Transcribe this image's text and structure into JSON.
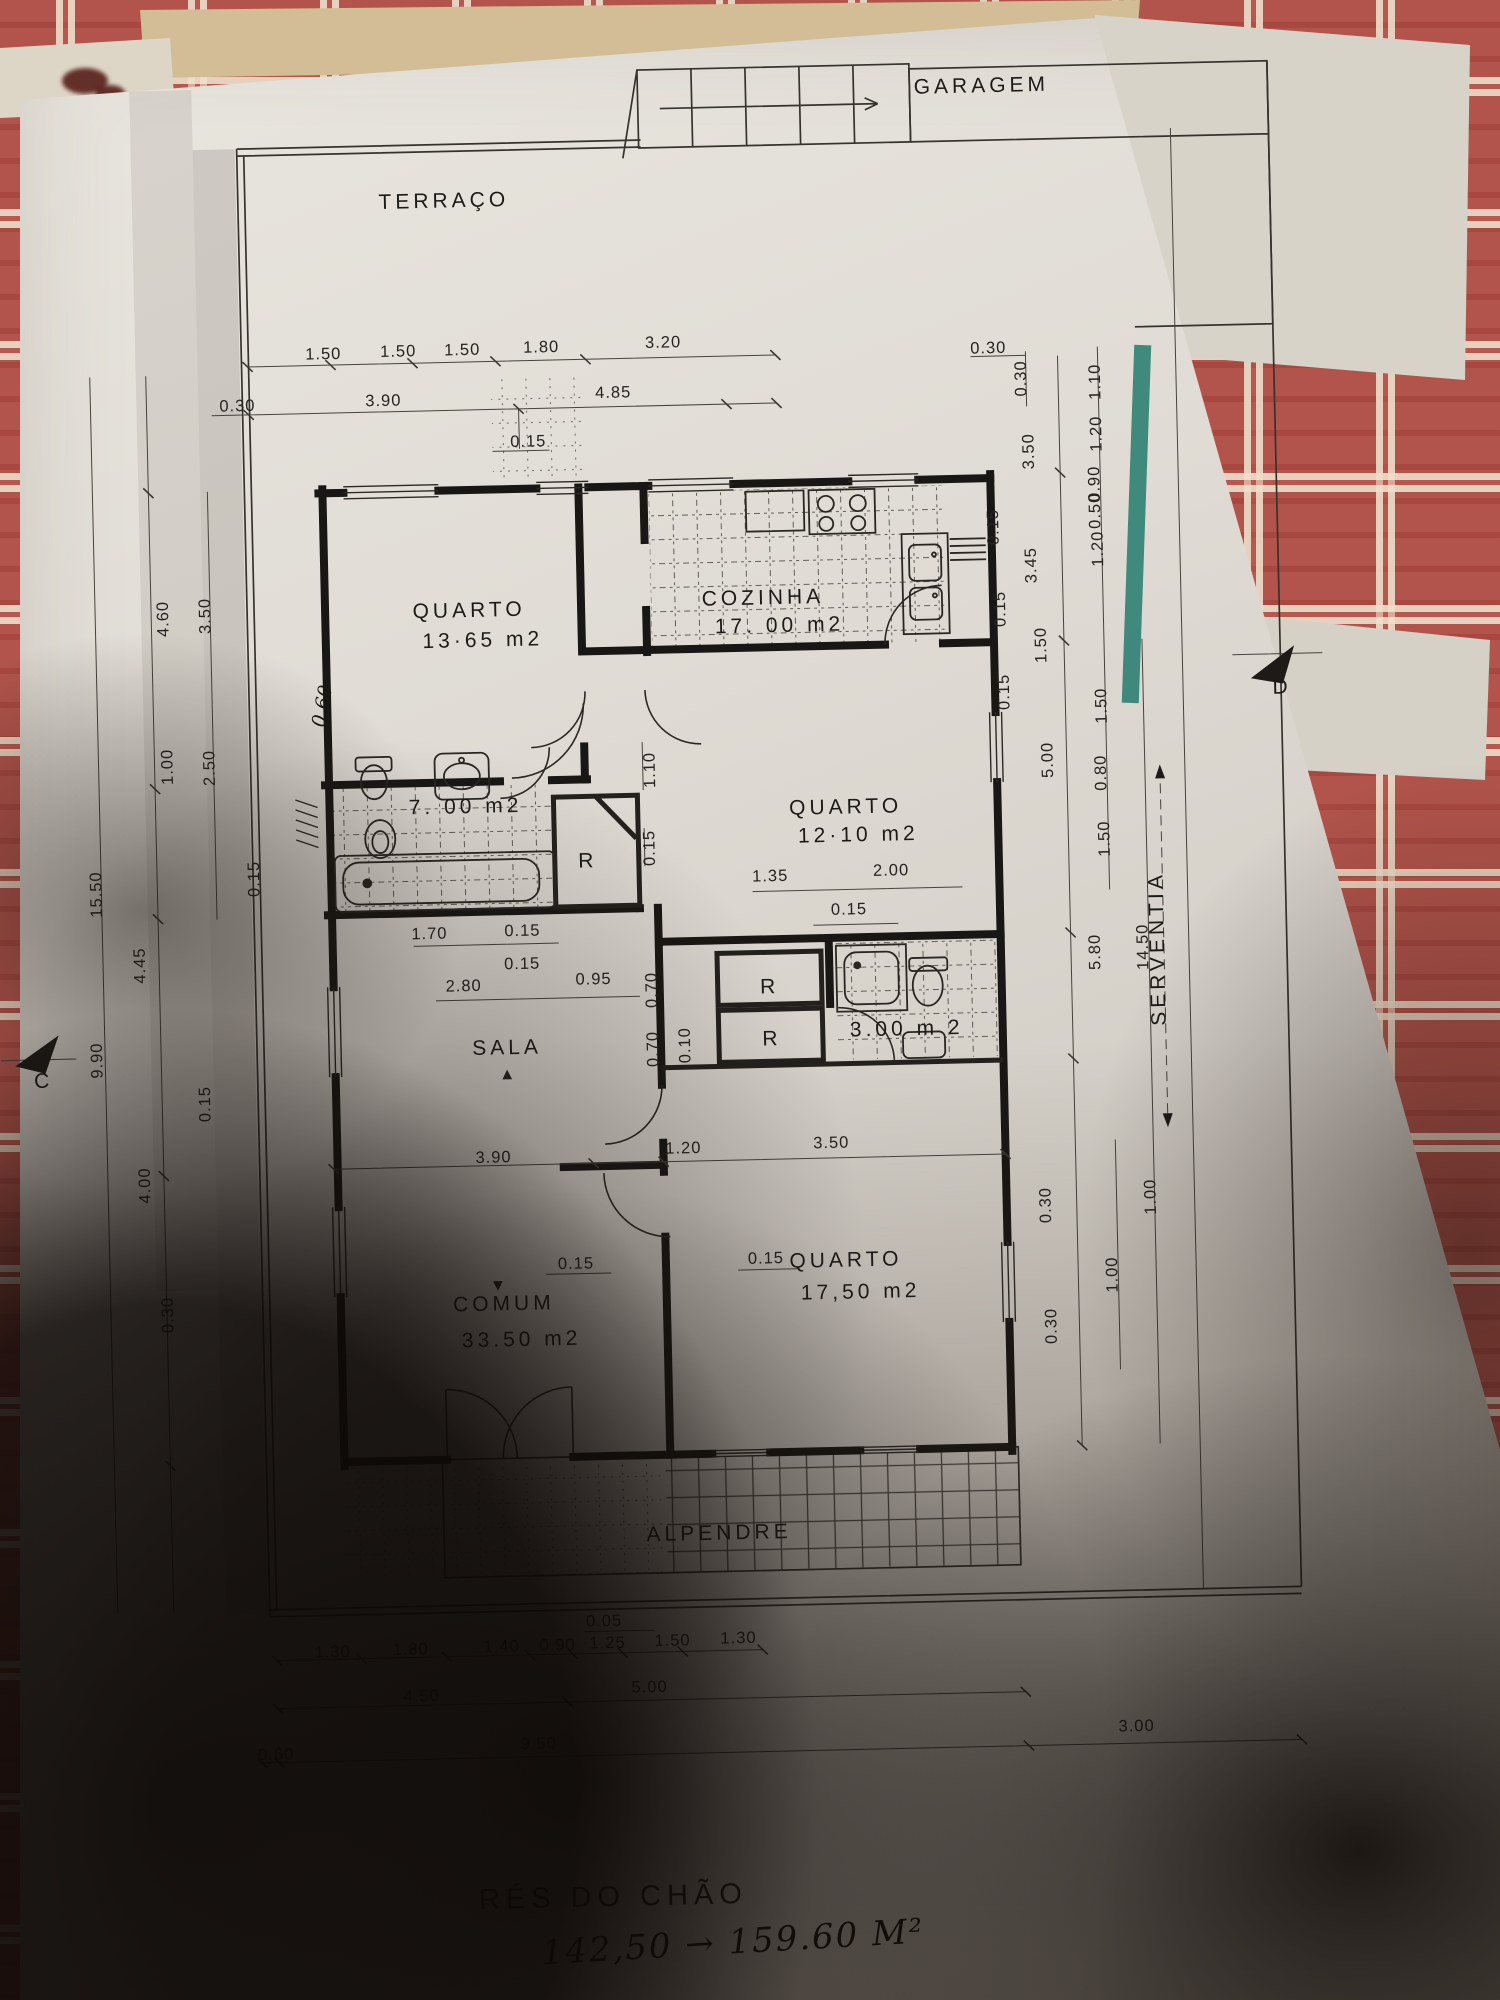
{
  "doc": {
    "kind": "floor plan photo",
    "floor_title": "RÉS DO CHÃO",
    "handwritten_note": "142,50 → 159.60 M²"
  },
  "colors": {
    "cloth_red": "#b2544b",
    "cloth_cream": "#eddcc2",
    "paper": "#e0dcd5",
    "ink": "#262320",
    "green_strip": "#2e8073"
  },
  "plan": {
    "garage_label": "GARAGEM",
    "title": "RÉS DO CHÃO",
    "note": "142,50 → 159.60 M²",
    "rooms": [
      {
        "name": "TERRAÇO"
      },
      {
        "name": "GARAGEM"
      },
      {
        "name": "QUARTO",
        "area": "13·65 m2"
      },
      {
        "name": "COZINHA",
        "area": "17. 00 m2"
      },
      {
        "name": "banho",
        "area": "7. 00 m2"
      },
      {
        "name": "QUARTO",
        "area": "12·10 m2"
      },
      {
        "name": "SALA"
      },
      {
        "name": "wc",
        "area": "3.00 m 2"
      },
      {
        "name": "COMUM",
        "area": "33.50 m2"
      },
      {
        "name": "QUARTO",
        "area": "17,50 m2"
      },
      {
        "name": "ALPENDRE"
      },
      {
        "name": "SERVENTIA"
      }
    ],
    "labels": [
      {
        "t": "TERRAÇO",
        "x": 462,
        "y": 203,
        "c": "room",
        "ls": 7,
        "n": "room-label-terraco"
      },
      {
        "t": "QUARTO",
        "x": 478,
        "y": 613,
        "c": "room",
        "n": "room-label-quarto1"
      },
      {
        "t": "13·65 m2",
        "x": 491,
        "y": 643,
        "c": "room",
        "s": 19,
        "ls": 2,
        "n": "area-label-quarto1"
      },
      {
        "t": "COZINHA",
        "x": 772,
        "y": 607,
        "c": "room",
        "ls": 5,
        "n": "room-label-cozinha"
      },
      {
        "t": "17. 00 m2",
        "x": 788,
        "y": 635,
        "c": "room",
        "s": 19,
        "ls": 2,
        "n": "area-label-cozinha"
      },
      {
        "t": "7. 00 m2",
        "x": 470,
        "y": 809,
        "c": "room",
        "s": 19,
        "ls": 2,
        "n": "area-label-banho"
      },
      {
        "t": "R",
        "x": 591,
        "y": 866,
        "c": "room",
        "s": 20,
        "n": "closet-label"
      },
      {
        "t": "QUARTO",
        "x": 850,
        "y": 818,
        "c": "room",
        "n": "room-label-quarto2"
      },
      {
        "t": "12·10 m2",
        "x": 862,
        "y": 846,
        "c": "room",
        "s": 19,
        "ls": 2,
        "n": "area-label-quarto2"
      },
      {
        "t": "SALA",
        "x": 506,
        "y": 1051,
        "c": "room",
        "ls": 6,
        "n": "room-label-sala"
      },
      {
        "t": "R",
        "x": 770,
        "y": 996,
        "c": "room",
        "s": 19,
        "n": "closet-label"
      },
      {
        "t": "R",
        "x": 771,
        "y": 1048,
        "c": "room",
        "s": 19,
        "n": "closet-label"
      },
      {
        "t": "3.00 m 2",
        "x": 906,
        "y": 1041,
        "c": "room",
        "s": 19,
        "ls": 1,
        "n": "area-label-wc"
      },
      {
        "t": "COMUM",
        "x": 497,
        "y": 1307,
        "c": "room",
        "ls": 5,
        "n": "room-label-comum"
      },
      {
        "t": "33.50 m2",
        "x": 514,
        "y": 1343,
        "c": "room",
        "s": 19,
        "ls": 2,
        "n": "area-label-comum"
      },
      {
        "t": "QUARTO",
        "x": 840,
        "y": 1271,
        "c": "room",
        "n": "room-label-quarto3"
      },
      {
        "t": "17,50 m2",
        "x": 854,
        "y": 1303,
        "c": "room",
        "s": 19,
        "ls": 2,
        "n": "area-label-quarto3"
      },
      {
        "t": "ALPENDRE",
        "x": 707,
        "y": 1541,
        "c": "room",
        "ls": 5,
        "n": "room-label-alpendre"
      },
      {
        "t": "SERVENTIA",
        "x": 1165,
        "y": 960,
        "c": "room",
        "r": -90,
        "ls": 7,
        "n": "label-serventia"
      },
      {
        "t": "C",
        "x": 42,
        "y": 1074,
        "c": "room",
        "s": 23,
        "n": "section-marker-c"
      },
      {
        "t": "D",
        "x": 1289,
        "y": 708,
        "c": "room",
        "s": 23,
        "n": "section-marker-d"
      },
      {
        "t": "▲",
        "x": 506,
        "y": 1076,
        "s": 13,
        "n": "arrow-mark"
      },
      {
        "t": "▼",
        "x": 492,
        "y": 1287,
        "s": 13,
        "n": "arrow-mark"
      },
      {
        "t": "1.50",
        "x": 338,
        "y": 352,
        "n": "dimension-label"
      },
      {
        "t": "1.50",
        "x": 413,
        "y": 351,
        "n": "dimension-label"
      },
      {
        "t": "1.50",
        "x": 477,
        "y": 351,
        "n": "dimension-label"
      },
      {
        "t": "1.80",
        "x": 556,
        "y": 350,
        "n": "dimension-label"
      },
      {
        "t": "3.20",
        "x": 678,
        "y": 348,
        "n": "dimension-label"
      },
      {
        "t": "0.30",
        "x": 251,
        "y": 402,
        "n": "dimension-label"
      },
      {
        "t": "3.90",
        "x": 397,
        "y": 400,
        "n": "dimension-label"
      },
      {
        "t": "4.85",
        "x": 627,
        "y": 397,
        "n": "dimension-label"
      },
      {
        "t": "0.15",
        "x": 541,
        "y": 444,
        "n": "dimension-label"
      },
      {
        "t": "0.30",
        "x": 1003,
        "y": 361,
        "n": "dimension-label"
      },
      {
        "t": "0.60",
        "x": 335,
        "y": 700,
        "r": -78,
        "c": "hand2",
        "n": "dimension-label"
      },
      {
        "t": "1.10",
        "x": 660,
        "y": 770,
        "r": -90,
        "n": "dimension-label"
      },
      {
        "t": "0.15",
        "x": 658,
        "y": 848,
        "r": -90,
        "n": "dimension-label"
      },
      {
        "t": "1.70",
        "x": 431,
        "y": 934,
        "n": "dimension-label"
      },
      {
        "t": "0.15",
        "x": 524,
        "y": 933,
        "n": "dimension-label"
      },
      {
        "t": "0.15",
        "x": 523,
        "y": 966,
        "n": "dimension-label"
      },
      {
        "t": "2.80",
        "x": 464,
        "y": 987,
        "n": "dimension-label"
      },
      {
        "t": "0.95",
        "x": 594,
        "y": 983,
        "n": "dimension-label"
      },
      {
        "t": "0.70",
        "x": 657,
        "y": 990,
        "r": -90,
        "n": "dimension-label"
      },
      {
        "t": "0.70",
        "x": 657,
        "y": 1049,
        "r": -90,
        "n": "dimension-label"
      },
      {
        "t": "0.10",
        "x": 689,
        "y": 1046,
        "r": -90,
        "n": "dimension-label"
      },
      {
        "t": "1.35",
        "x": 773,
        "y": 884,
        "n": "dimension-label"
      },
      {
        "t": "2.00",
        "x": 894,
        "y": 881,
        "n": "dimension-label"
      },
      {
        "t": "0.15",
        "x": 851,
        "y": 919,
        "n": "dimension-label"
      },
      {
        "t": "3.90",
        "x": 490,
        "y": 1159,
        "n": "dimension-label"
      },
      {
        "t": "1.20",
        "x": 680,
        "y": 1154,
        "n": "dimension-label"
      },
      {
        "t": "3.50",
        "x": 828,
        "y": 1152,
        "n": "dimension-label"
      },
      {
        "t": "0.15",
        "x": 570,
        "y": 1267,
        "n": "dimension-label"
      },
      {
        "t": "0.15",
        "x": 760,
        "y": 1266,
        "n": "dimension-label"
      },
      {
        "t": "0.05",
        "x": 590,
        "y": 1625,
        "n": "dimension-label"
      },
      {
        "t": "1.30",
        "x": 318,
        "y": 1650,
        "n": "dimension-label"
      },
      {
        "t": "1.80",
        "x": 396,
        "y": 1649,
        "n": "dimension-label"
      },
      {
        "t": "1.40",
        "x": 487,
        "y": 1648,
        "n": "dimension-label"
      },
      {
        "t": "0.90",
        "x": 543,
        "y": 1648,
        "n": "dimension-label"
      },
      {
        "t": "1.25",
        "x": 593,
        "y": 1647,
        "n": "dimension-label"
      },
      {
        "t": "1.50",
        "x": 658,
        "y": 1646,
        "n": "dimension-label"
      },
      {
        "t": "1.30",
        "x": 724,
        "y": 1645,
        "n": "dimension-label"
      },
      {
        "t": "4.50",
        "x": 406,
        "y": 1696,
        "n": "dimension-label"
      },
      {
        "t": "5.00",
        "x": 634,
        "y": 1692,
        "n": "dimension-label"
      },
      {
        "t": "0.60",
        "x": 259,
        "y": 1751,
        "n": "dimension-label"
      },
      {
        "t": "9.50",
        "x": 522,
        "y": 1746,
        "n": "dimension-label"
      },
      {
        "t": "3.00",
        "x": 1120,
        "y": 1742,
        "n": "dimension-label"
      },
      {
        "t": "0.30",
        "x": 1040,
        "y": 387,
        "r": -90,
        "n": "dimension-label"
      },
      {
        "t": "3.50",
        "x": 1046,
        "y": 460,
        "r": -90,
        "n": "dimension-label"
      },
      {
        "t": "0.15",
        "x": 1009,
        "y": 535,
        "r": -90,
        "n": "dimension-label"
      },
      {
        "t": "3.45",
        "x": 1046,
        "y": 574,
        "r": -90,
        "n": "dimension-label"
      },
      {
        "t": "0.15",
        "x": 1014,
        "y": 617,
        "r": -90,
        "n": "dimension-label"
      },
      {
        "t": "1.50",
        "x": 1054,
        "y": 654,
        "r": -90,
        "n": "dimension-label"
      },
      {
        "t": "0.15",
        "x": 1016,
        "y": 700,
        "r": -90,
        "n": "dimension-label"
      },
      {
        "t": "5.00",
        "x": 1058,
        "y": 769,
        "r": -90,
        "n": "dimension-label"
      },
      {
        "t": "1.10",
        "x": 1114,
        "y": 392,
        "r": -90,
        "n": "dimension-label"
      },
      {
        "t": "1.20",
        "x": 1114,
        "y": 444,
        "r": -90,
        "n": "dimension-label"
      },
      {
        "t": "0.90",
        "x": 1111,
        "y": 494,
        "r": -90,
        "n": "dimension-label"
      },
      {
        "t": "0.50",
        "x": 1111,
        "y": 521,
        "r": -90,
        "n": "dimension-label"
      },
      {
        "t": "1.20",
        "x": 1113,
        "y": 559,
        "r": -90,
        "n": "dimension-label"
      },
      {
        "t": "1.50",
        "x": 1113,
        "y": 716,
        "r": -90,
        "n": "dimension-label"
      },
      {
        "t": "0.80",
        "x": 1111,
        "y": 783,
        "r": -90,
        "n": "dimension-label"
      },
      {
        "t": "1.50",
        "x": 1113,
        "y": 849,
        "r": -90,
        "n": "dimension-label"
      },
      {
        "t": "5.80",
        "x": 1101,
        "y": 962,
        "r": -90,
        "n": "dimension-label"
      },
      {
        "t": "14.50",
        "x": 1149,
        "y": 958,
        "r": -90,
        "n": "dimension-label"
      },
      {
        "t": "0.30",
        "x": 1046,
        "y": 1214,
        "r": -90,
        "n": "dimension-label"
      },
      {
        "t": "1.00",
        "x": 1151,
        "y": 1208,
        "r": -90,
        "n": "dimension-label"
      },
      {
        "t": "1.00",
        "x": 1111,
        "y": 1285,
        "r": -90,
        "n": "dimension-label"
      },
      {
        "t": "0.30",
        "x": 1049,
        "y": 1335,
        "r": -90,
        "n": "dimension-label"
      },
      {
        "t": "15.50",
        "x": 104,
        "y": 882,
        "r": -90,
        "n": "dimension-label"
      },
      {
        "t": "4.60",
        "x": 177,
        "y": 608,
        "r": -90,
        "n": "dimension-label"
      },
      {
        "t": "3.50",
        "x": 219,
        "y": 606,
        "r": -90,
        "n": "dimension-label"
      },
      {
        "t": "1.00",
        "x": 178,
        "y": 756,
        "r": -90,
        "n": "dimension-label"
      },
      {
        "t": "2.50",
        "x": 220,
        "y": 758,
        "r": -90,
        "n": "dimension-label"
      },
      {
        "t": "0.15",
        "x": 262,
        "y": 870,
        "r": -90,
        "n": "dimension-label"
      },
      {
        "t": "4.45",
        "x": 146,
        "y": 954,
        "r": -90,
        "n": "dimension-label"
      },
      {
        "t": "9.90",
        "x": 101,
        "y": 1048,
        "r": -90,
        "n": "dimension-label"
      },
      {
        "t": "0.15",
        "x": 208,
        "y": 1094,
        "r": -90,
        "n": "dimension-label"
      },
      {
        "t": "4.00",
        "x": 146,
        "y": 1174,
        "r": -90,
        "n": "dimension-label"
      },
      {
        "t": "0.30",
        "x": 166,
        "y": 1304,
        "r": -90,
        "n": "dimension-label"
      }
    ]
  }
}
